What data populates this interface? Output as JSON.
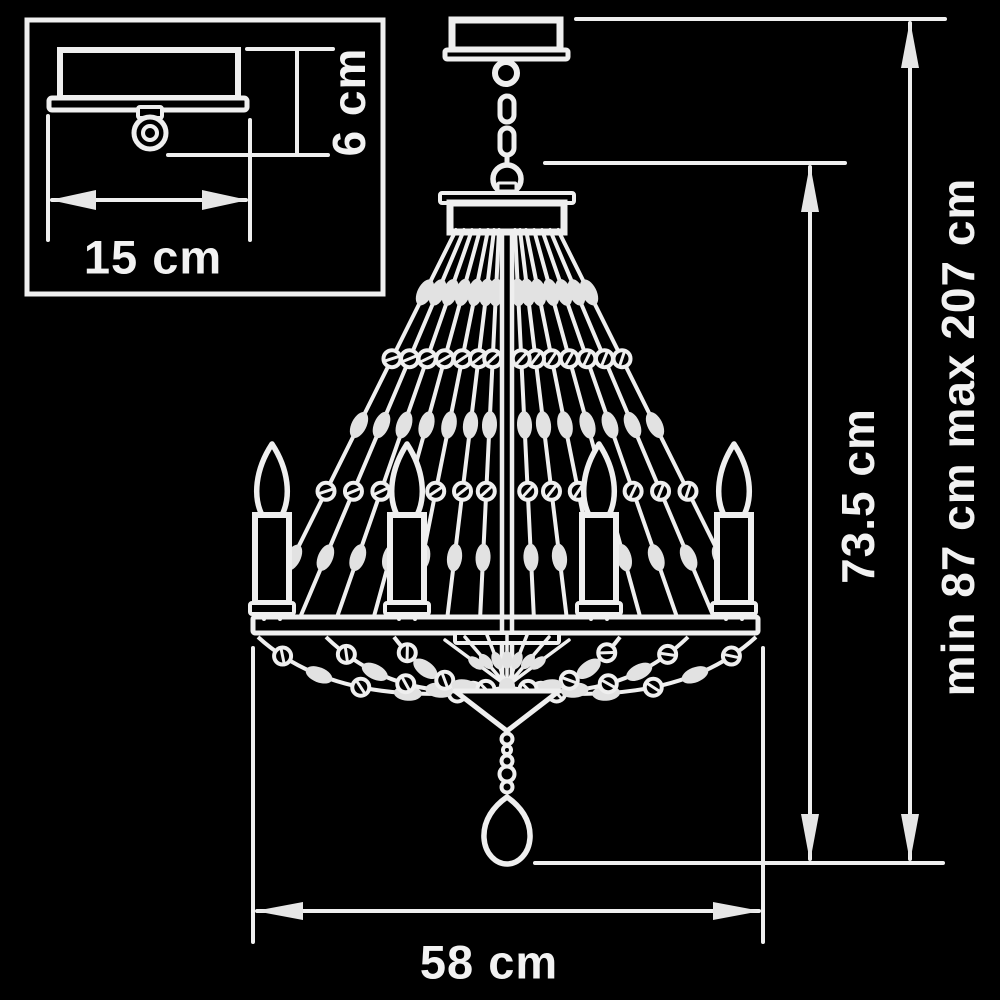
{
  "colors": {
    "background": "#000000",
    "line": "#efefef",
    "bead": "#e2e2e2",
    "arrow": "#e6e6e6",
    "text": "#f2f2f2"
  },
  "labels": {
    "canopy_width": "15 cm",
    "canopy_height": "6 cm",
    "fixture_height": "73.5 cm",
    "overall_height": "min 87 cm max 207 cm",
    "fixture_width": "58 cm"
  }
}
